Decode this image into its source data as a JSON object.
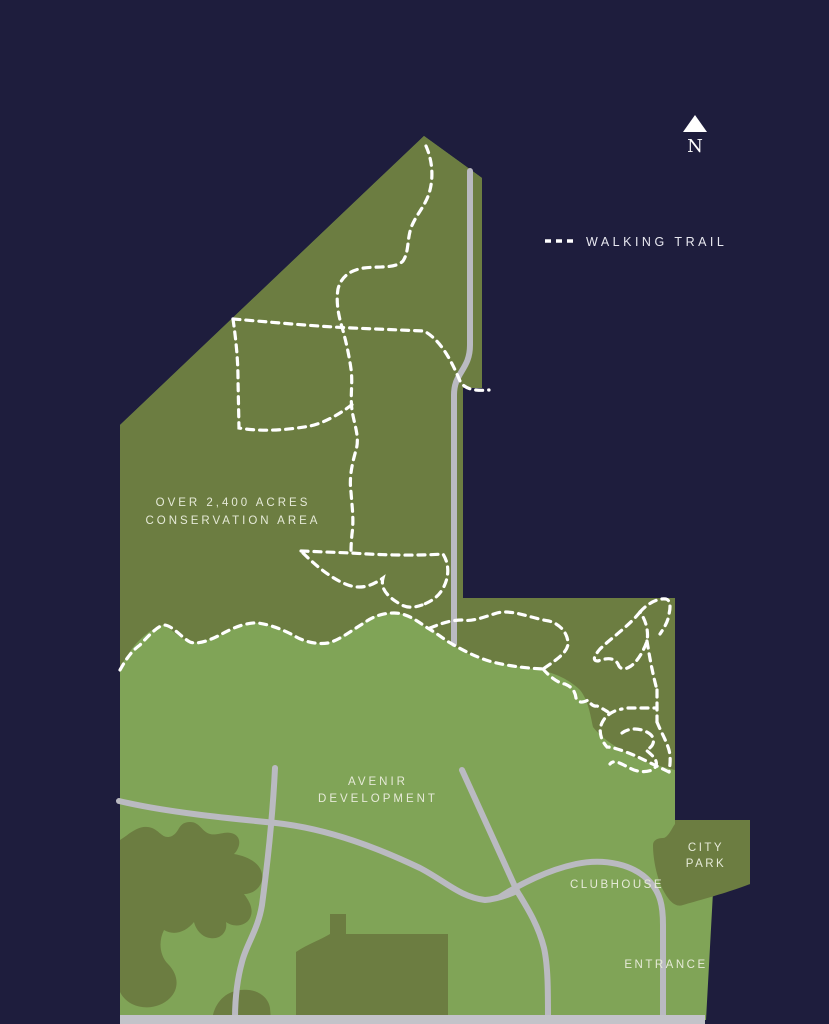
{
  "map": {
    "legend": {
      "walking_trail_label": "WALKING TRAIL",
      "trail_sample_icon": "dashed-trail-sample"
    },
    "compass": {
      "icon": "north-arrow-icon",
      "label": "N"
    },
    "labels": {
      "conservation_line1": "OVER 2,400 ACRES",
      "conservation_line2": "CONSERVATION AREA",
      "development_line1": "AVENIR",
      "development_line2": "DEVELOPMENT",
      "clubhouse": "CLUBHOUSE",
      "city_park_line1": "CITY",
      "city_park_line2": "PARK",
      "entrance": "ENTRANCE"
    },
    "colors": {
      "background_navy": "#1e1d3d",
      "conservation_olive": "#6c7d41",
      "development_green": "#80a457",
      "road_gray": "#babac1",
      "trail_white": "#ffffff",
      "label_text": "#e6ead8"
    }
  }
}
